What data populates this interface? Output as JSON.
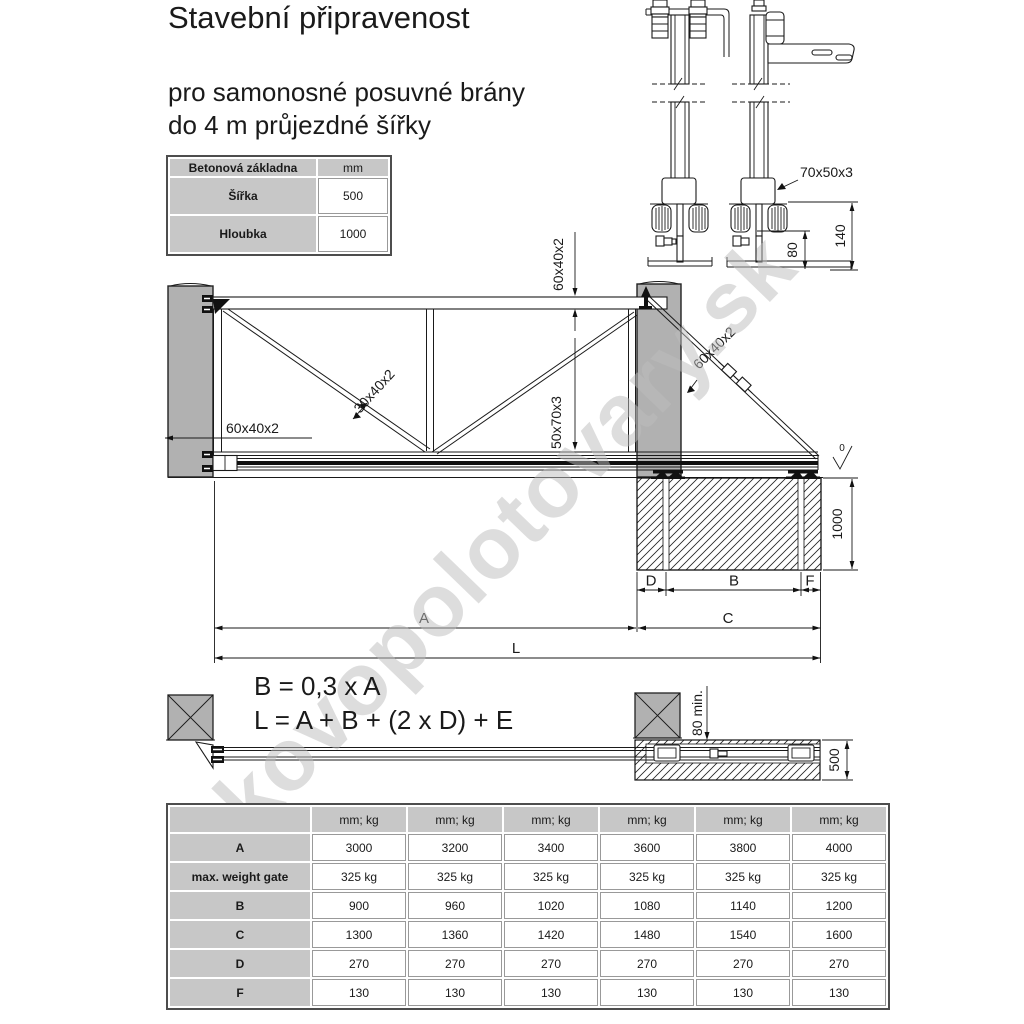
{
  "title": "Stavební připravenost",
  "subtitle_line1": "pro samonosné posuvné brány",
  "subtitle_line2": "do 4 m průjezdné šířky",
  "base_table": {
    "title": "Betonová základna",
    "unit": "mm",
    "rows": [
      {
        "label": "Šířka",
        "value": "500"
      },
      {
        "label": "Hloubka",
        "value": "1000"
      }
    ]
  },
  "formulas": {
    "line1": "B = 0,3 x A",
    "line2": "L = A + B + (2 x D) + E"
  },
  "watermark": "kovopolotovary.sk",
  "drawing": {
    "labels": {
      "top_rail": "60x40x2",
      "brace": "30x40x2",
      "rail": "50x70x3",
      "frame": "60x40x2",
      "tail": "60x40x2",
      "depth": "1000",
      "surface": "0",
      "dim_a": "A",
      "dim_b": "B",
      "dim_c": "C",
      "dim_d": "D",
      "dim_f": "F",
      "dim_l": "L"
    },
    "detail": {
      "profile": "70x50x3",
      "dim80": "80",
      "dim140": "140"
    },
    "top_view": {
      "offset": "80 min.",
      "width": "500"
    }
  },
  "spec_table": {
    "unit_header": "mm; kg",
    "rows": [
      {
        "label": "A",
        "values": [
          "3000",
          "3200",
          "3400",
          "3600",
          "3800",
          "4000"
        ]
      },
      {
        "label": "max. weight gate",
        "values": [
          "325 kg",
          "325 kg",
          "325 kg",
          "325 kg",
          "325 kg",
          "325 kg"
        ]
      },
      {
        "label": "B",
        "values": [
          "900",
          "960",
          "1020",
          "1080",
          "1140",
          "1200"
        ]
      },
      {
        "label": "C",
        "values": [
          "1300",
          "1360",
          "1420",
          "1480",
          "1540",
          "1600"
        ]
      },
      {
        "label": "D",
        "values": [
          "270",
          "270",
          "270",
          "270",
          "270",
          "270"
        ]
      },
      {
        "label": "F",
        "values": [
          "130",
          "130",
          "130",
          "130",
          "130",
          "130"
        ]
      }
    ]
  }
}
